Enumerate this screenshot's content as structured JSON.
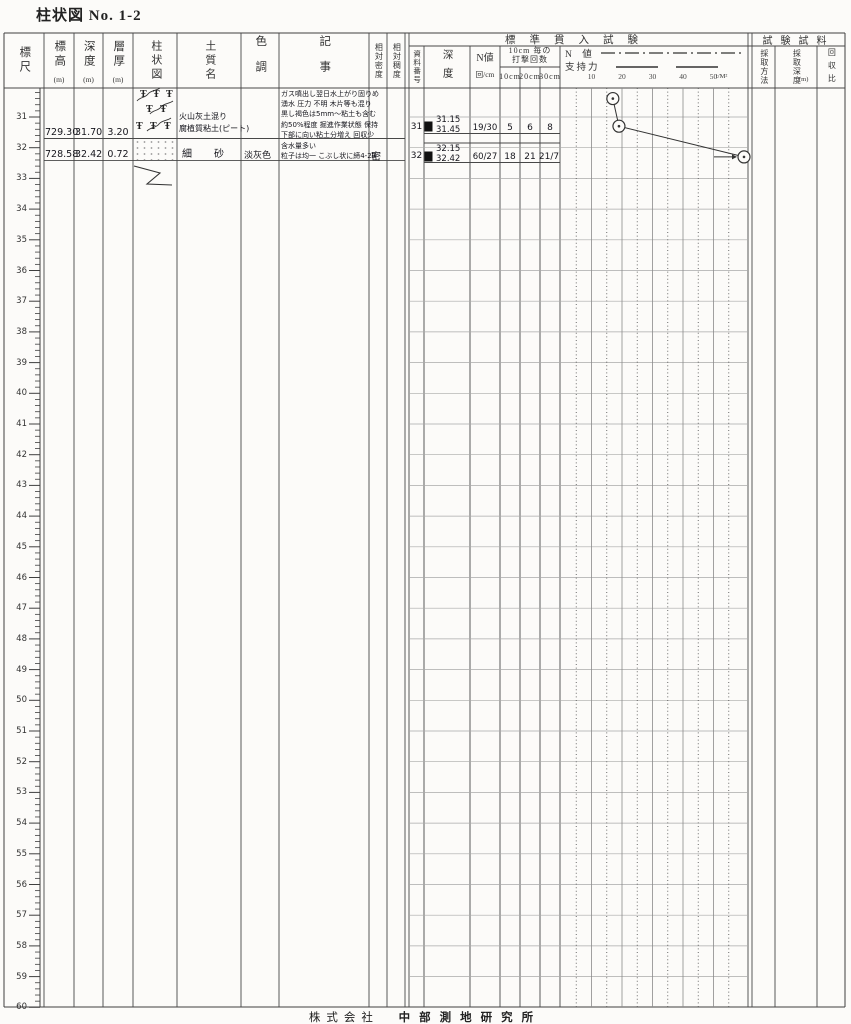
{
  "title": "柱状図 No. 1-2",
  "footer": {
    "company": "株式会社",
    "name": "中部測地研究所"
  },
  "columns": {
    "scale": "標尺",
    "elevation": "標高",
    "elevation_unit": "(m)",
    "depth": "深度",
    "depth_unit": "(m)",
    "thickness": "層厚",
    "thickness_unit": "(m)",
    "column_fig": "柱状図",
    "soil_name": "土質名",
    "color_tone": "色調",
    "remarks": "記事",
    "rel_density": "相対密度",
    "rel_consistency": "相対稠度"
  },
  "spt": {
    "header": "標準貫入試験",
    "sample_no": "資料番号",
    "depth": "深度",
    "n_value": "N値",
    "n_value_unit": "回/cm",
    "blows_header_1": "10cm 毎の",
    "blows_header_2": "打撃回数",
    "blows_cols": [
      "10cm",
      "20cm",
      "30cm"
    ],
    "legend_n": "N 値",
    "legend_bearing": "支持力",
    "axis_unit": "t/M²"
  },
  "test_sample": {
    "header": "試験試料",
    "method": "採取方法",
    "sampling_depth": "採取深度",
    "sampling_depth_unit": "(m)",
    "recovery": "回収比"
  },
  "ruler": {
    "start_m": 31,
    "end_m": 60
  },
  "column_symbols": {
    "peat_glyph": "Ŧ"
  },
  "layers": [
    {
      "elevation": "729.30",
      "depth": "31.70",
      "thickness": "3.20",
      "soil_line1": "火山灰土混り",
      "soil_line2": "腐植質粘土(ピート)",
      "color_tone": "",
      "remarks": [
        "ガス噴出し翌日水上がり固りめ",
        "湧水 圧力 不明 木片等も混り",
        "黒し褐色は5mm〜粘土も含む",
        "約50%程度 掘進作業状態 保持",
        "下部に向い粘土分増え 回収少"
      ],
      "density": ""
    },
    {
      "elevation": "728.58",
      "depth": "32.42",
      "thickness": "0.72",
      "soil_line1": "細　砂",
      "soil_line2": "",
      "color_tone": "淡灰色",
      "remarks": [
        "含水量多い",
        "粒子は均一 こぶし状に締4-2B"
      ],
      "density": "密"
    }
  ],
  "samples": [
    {
      "no": "31",
      "top": "31.15",
      "bottom": "31.45",
      "n": "19/30",
      "b10": "5",
      "b20": "6",
      "b30": "8"
    },
    {
      "no": "32",
      "top": "32.15",
      "bottom": "32.42",
      "n": "60/27",
      "b10": "18",
      "b20": "21",
      "b30": "21/7"
    }
  ],
  "chart_data": {
    "type": "line",
    "title": "標準貫入試験 N値",
    "xlabel": "N値",
    "ylabel": "深度 (m)",
    "xlim": [
      0,
      60
    ],
    "x_ticks": [
      10,
      20,
      30,
      40,
      50
    ],
    "legend": [
      "N値",
      "支持力"
    ],
    "points": [
      {
        "depth": 30.4,
        "n": 17
      },
      {
        "depth": 31.3,
        "n": 19
      },
      {
        "depth": 32.3,
        "n": 60
      }
    ]
  }
}
